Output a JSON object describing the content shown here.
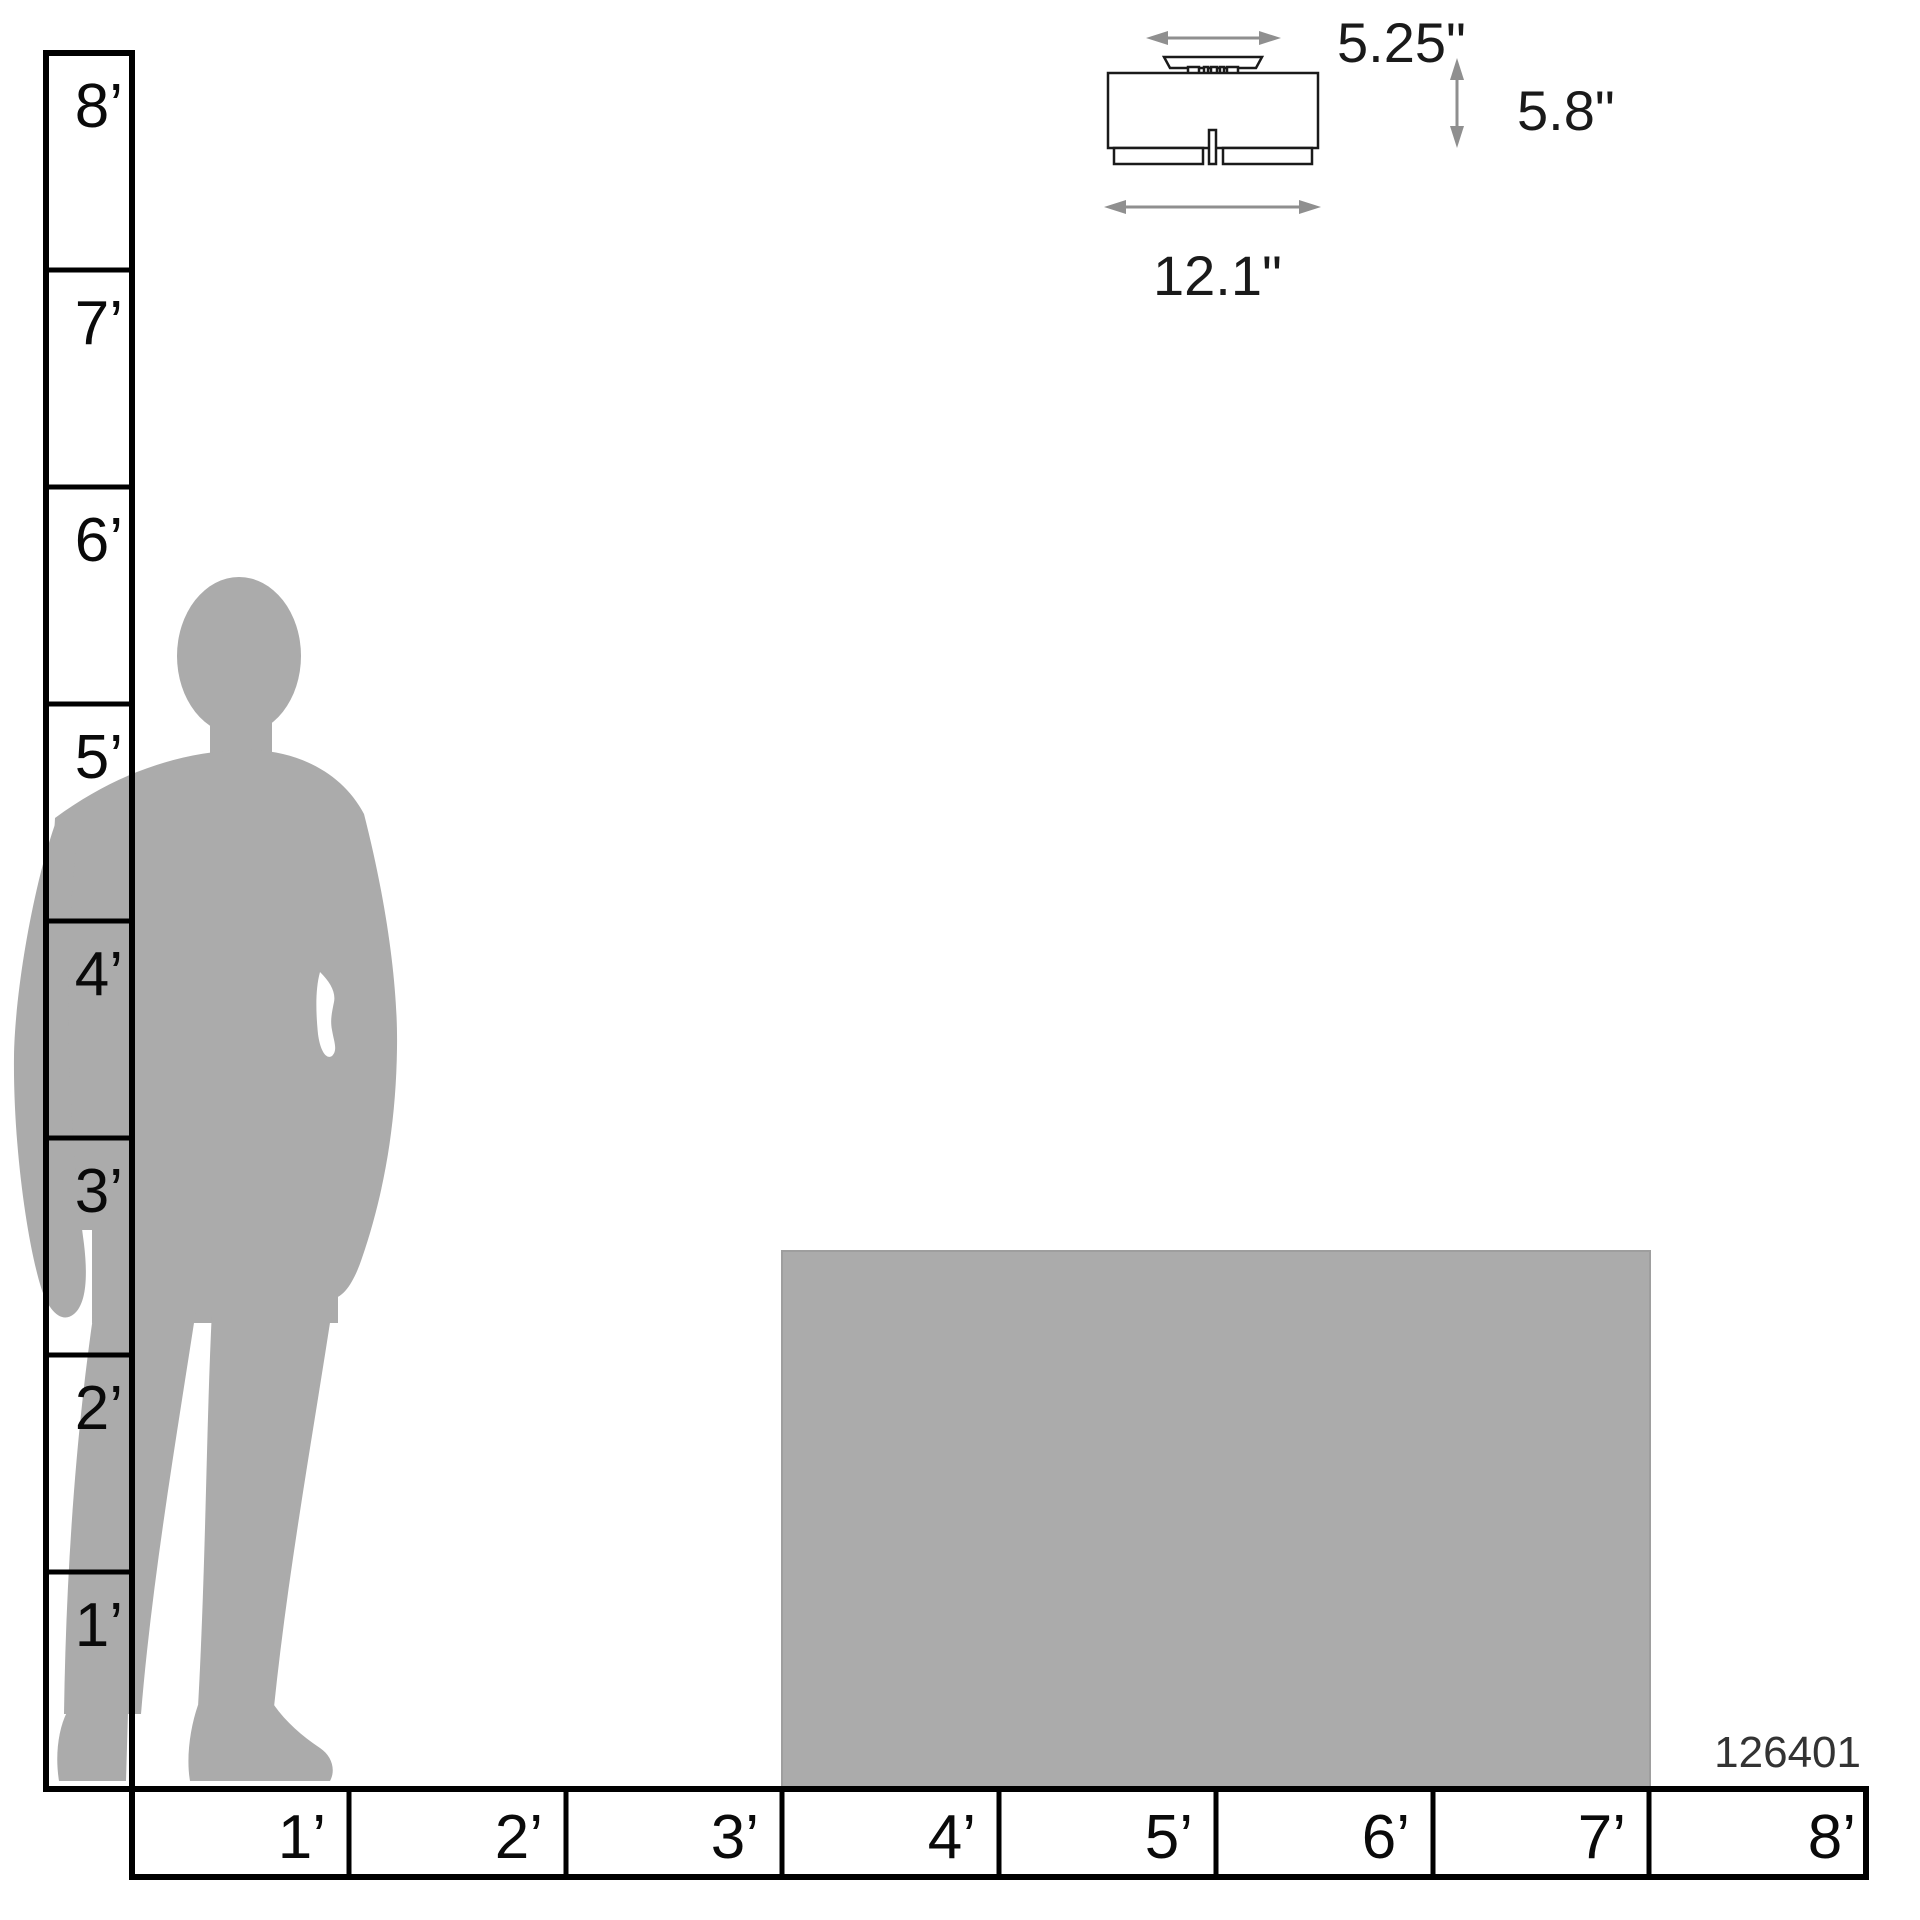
{
  "product": {
    "number": "126401"
  },
  "fixture": {
    "name": "flush-mount-ceiling-light-line-drawing",
    "canopy_width_label": "5.25\"",
    "height_label": "5.8\"",
    "width_label": "12.1\""
  },
  "rulers": {
    "vertical": {
      "unit": "feet",
      "labels": [
        "8’",
        "7’",
        "6’",
        "5’",
        "4’",
        "3’",
        "2’",
        "1’"
      ]
    },
    "horizontal": {
      "unit": "feet",
      "labels": [
        "1’",
        "2’",
        "3’",
        "4’",
        "5’",
        "6’",
        "7’",
        "8’"
      ]
    }
  },
  "reference_objects": {
    "person": {
      "type": "standing-man-silhouette",
      "color": "#ABABAB"
    },
    "box": {
      "type": "reference-rectangle",
      "color": "#ABABAB"
    }
  },
  "colors": {
    "ruler_line": "#000000",
    "dimension_arrow": "#8f8f8f",
    "fixture_outline": "#1a1a1a",
    "label_text": "#1a1a1a",
    "product_number_text": "#333333",
    "silhouette_gray": "#ABABAB"
  }
}
